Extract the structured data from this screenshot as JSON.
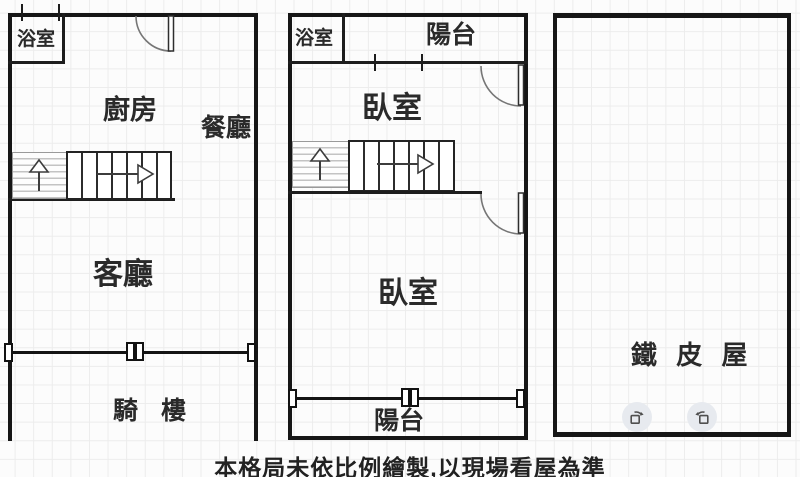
{
  "caption": "本格局未依比例繪製,以現場看屋為準",
  "units": {
    "left": {
      "bathroom": "浴室",
      "kitchen": "廚房",
      "dining": "餐廳",
      "living": "客廳",
      "arcade": "騎 樓"
    },
    "middle": {
      "bathroom": "浴室",
      "balcony_top": "陽台",
      "bedroom_upper": "臥室",
      "bedroom_lower": "臥室",
      "balcony_bottom": "陽台"
    },
    "right": {
      "name": "鐵 皮 屋"
    }
  },
  "controls": {
    "rotate_cw_icon": "rotate-cw-icon",
    "rotate_ccw_icon": "rotate-ccw-icon"
  },
  "colors": {
    "wall": "#161616",
    "paper": "#fcfcfc",
    "grid": "#ececec",
    "stair_line": "#2c2c2c",
    "door_arc": "#767676",
    "icon_circle_bg": "#e7eaef",
    "icon_stroke": "#4f4f4f"
  }
}
